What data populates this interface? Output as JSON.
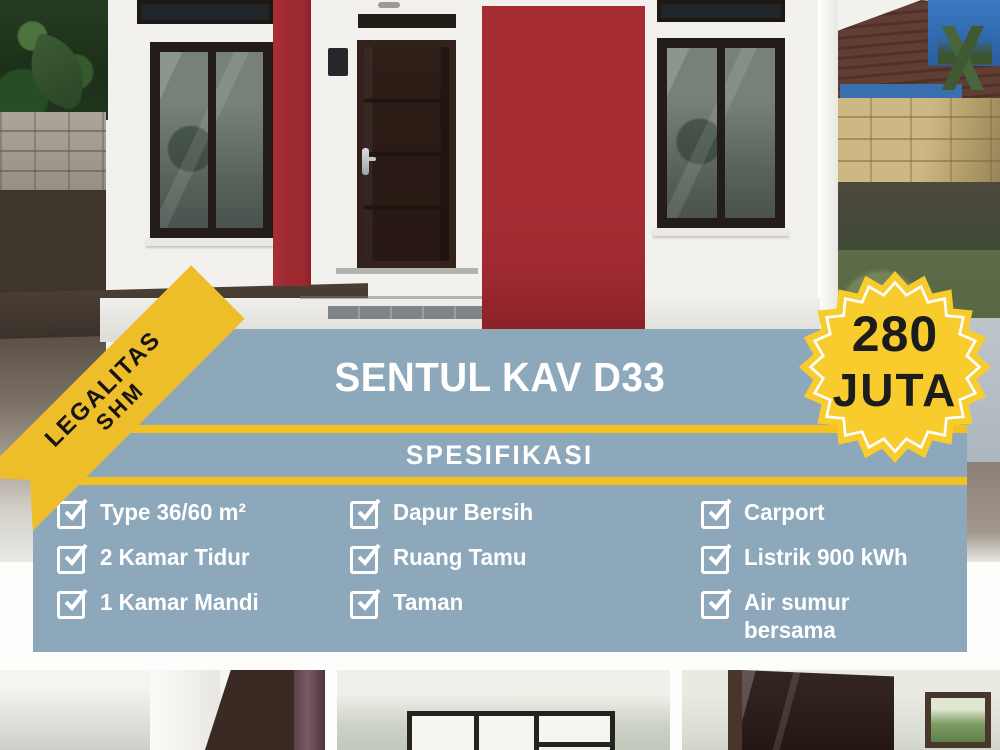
{
  "poster": {
    "ribbon": {
      "line1": "LEGALITAS",
      "line2": "SHM"
    },
    "title": "SENTUL KAV D33",
    "price_badge": {
      "amount": "280",
      "unit": "JUTA"
    },
    "section_header": "SPESIFIKASI",
    "specs": {
      "column1": [
        "Type 36/60 m²",
        "2 Kamar Tidur",
        "1 Kamar Mandi"
      ],
      "column2": [
        "Dapur Bersih",
        "Ruang Tamu",
        "Taman"
      ],
      "column3": [
        "Carport",
        "Listrik 900 kWh",
        "Air sumur\nbersama"
      ]
    },
    "icons": {
      "checkbox": "checked-checkbox-icon",
      "badge_shape": "starburst-icon"
    },
    "colors": {
      "panel_blue": "#8da7bb",
      "accent_yellow": "#f3c21e",
      "ribbon_yellow": "#eebd2a",
      "badge_yellow": "#f9cc2d",
      "wall_red": "#9e2a31",
      "text_white": "#ffffff",
      "text_black": "#1c1c1c"
    }
  }
}
